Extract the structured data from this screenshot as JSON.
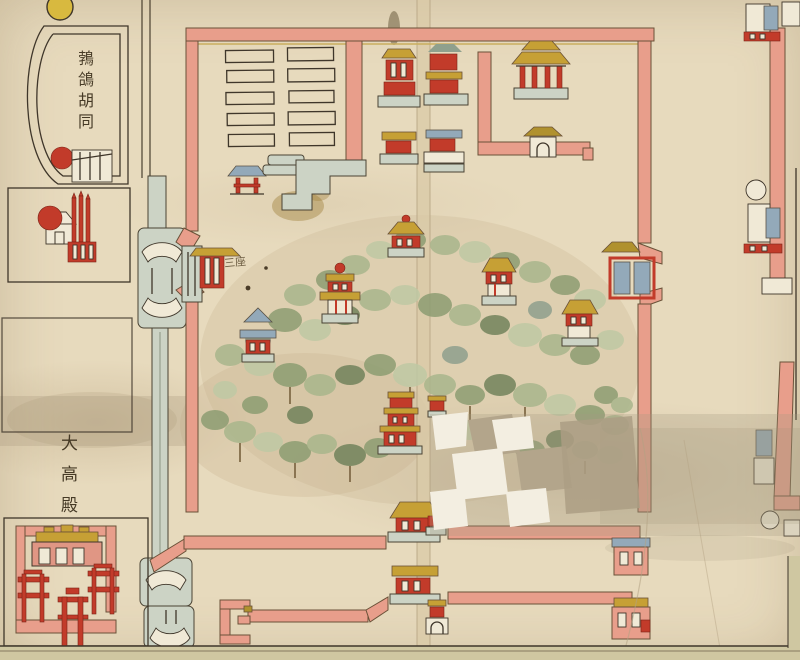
{
  "map": {
    "labels": {
      "hutong": "鵓鴿胡同",
      "dagaodian": "大高殿",
      "gate_note": "三座"
    },
    "features": [
      "walled-hill-garden-enclosure",
      "hill-with-trees",
      "hill-pavilions",
      "tiered-pagoda",
      "barracks-rows-enclosure",
      "northeast-courtyard-gate-hall",
      "west-gate-tower",
      "east-gate-tower",
      "fold-gate-towers",
      "canal-with-bridges",
      "dagaodian-temple-complex",
      "red-pailou-archways",
      "horseshoe-alley",
      "shrine-with-red-ball",
      "east-outer-wall-gates",
      "paper-damage-patches",
      "center-fold-crease",
      "sheet-edge-band"
    ],
    "colors": {
      "paper": "#e5d8ba",
      "wall_pink": "#e89e8b",
      "wall_highlight": "#f2bda6",
      "roof_gold": "#c6a035",
      "roof_blue": "#93a9b9",
      "building_red": "#c23b2a",
      "tree_green": "#9aaa7f",
      "tree_green_dark": "#72835c",
      "canal_gray": "#ccd3c5",
      "ink": "#3f362a",
      "damage_white": "#f3eee1",
      "stain_taupe": "#b3a58b",
      "edge_band": "#cfc7a1"
    }
  }
}
